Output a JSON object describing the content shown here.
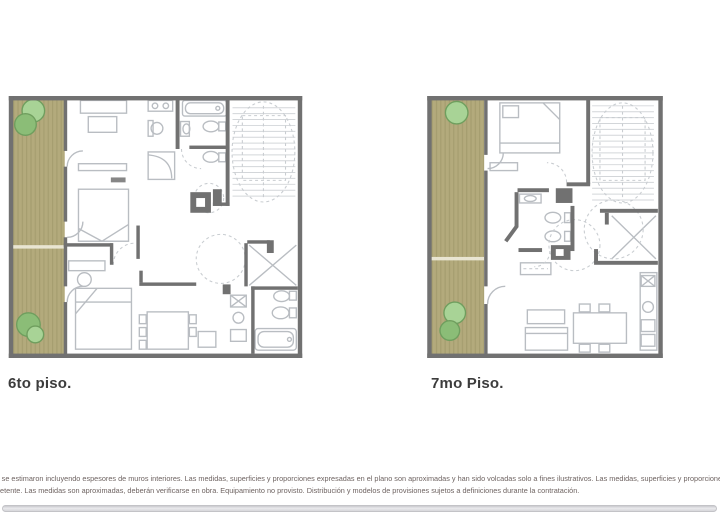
{
  "document": {
    "type": "real-estate floor plan sheet",
    "background": "#ffffff"
  },
  "plans": [
    {
      "id": "plan-6",
      "caption": "6to piso."
    },
    {
      "id": "plan-7",
      "caption": "7mo Piso."
    }
  ],
  "disclaimer": {
    "line1": "s se estimaron incluyendo espesores de muros interiores. Las medidas, superficies y proporciones expresadas en el plano son aproximadas y han sido volcadas solo a fines ilustrativos. Las medidas, superficies y proporciones finales surgirán de los",
    "line2": "petente. Las medidas son aproximadas, deberán verificarse en obra. Equipamiento no provisto. Distribución y modelos de provisiones sujetos a definiciones durante la contratación."
  },
  "colors": {
    "background": "#ffffff",
    "wall": "#717171",
    "deck-base": "#b3aa7c",
    "deck-stripe": "#a59d6f",
    "deck-divider": "#e9e5d2",
    "tree-light": "#a8d396",
    "tree-dark": "#8bbd77",
    "tree-stroke": "#6f9e5e",
    "furniture-line": "#b9bdc2",
    "dashed-line": "#c9cdd1",
    "tread-line": "#d3d6d9",
    "caption-text": "#3c3c3c",
    "disclaimer-text": "#6e6361",
    "scrollbar": "#d9d9dc"
  }
}
